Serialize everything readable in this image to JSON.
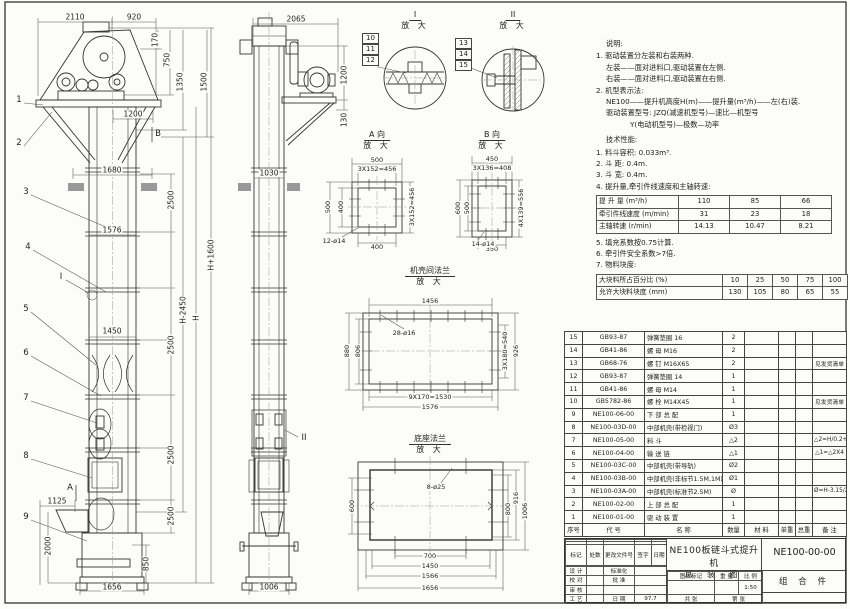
{
  "front": {
    "dims": {
      "d2110": "2110",
      "d920": "920",
      "d170": "170",
      "d750": "750",
      "d1350": "1350",
      "d1500": "1500",
      "d1200": "1200",
      "d1680": "1680",
      "d1576": "1576",
      "d1450": "1450",
      "d2500": "2500",
      "dHm2450": "H-2450",
      "dH": "H",
      "dHp1600": "H+1600",
      "d1125": "1125",
      "d2000": "2000",
      "d850": "850",
      "d1656": "1656"
    },
    "balloons": [
      "1",
      "2",
      "3",
      "4",
      "5",
      "6",
      "7",
      "8",
      "9"
    ],
    "markers": {
      "a": "A",
      "b": "B",
      "i": "I",
      "ii": "II"
    }
  },
  "side": {
    "dims": {
      "d2065": "2065",
      "d1200": "1200",
      "d130": "130",
      "d1030": "1030",
      "d1006": "1006"
    }
  },
  "details": {
    "enlarged": "放 大",
    "i": {
      "title": "I",
      "balloons": [
        "10",
        "11",
        "12"
      ]
    },
    "ii": {
      "title": "II",
      "balloons": [
        "13",
        "14",
        "15"
      ]
    },
    "a": {
      "title": "A 向",
      "top": "500",
      "top2": "3X152=456",
      "left": "500",
      "left2": "400",
      "bottom": "400",
      "right": "3X152=456",
      "holes": "12-ø14"
    },
    "b": {
      "title": "B 向",
      "top": "450",
      "top2": "3X136=408",
      "left": "600",
      "left2": "500",
      "bottom": "350",
      "right": "4X139=556",
      "holes": "14-ø14"
    },
    "flange": {
      "title": "机壳间法兰",
      "top": "1456",
      "holes": "28-ø16",
      "left": "880",
      "left2": "806",
      "right": "3X180=540",
      "right2": "926",
      "bottom": "9X170=1530",
      "bottom2": "1576"
    },
    "base": {
      "title": "底座法兰",
      "holes": "8-ø25",
      "left": "600",
      "right": "800",
      "right2": "916",
      "right3": "1006",
      "bottom": "700",
      "bottom2": "1450",
      "bottom3": "1566",
      "bottom4": "1656"
    }
  },
  "notes": {
    "title": "说明:",
    "lines": [
      "1. 驱动装置分左装和右装两种.",
      "左装——面对进料口,驱动装置在左侧.",
      "右装——面对进料口,驱动装置在右侧.",
      "2. 机型表示法:",
      "NE100——提升机高度H(m)——提升量(m³/h)——左(右)装.",
      "驱动装置型号: JZQ(减速机型号)—速比—机型号",
      "Y(电动机型号)—极数—功率"
    ]
  },
  "tech": {
    "title": "技术性能:",
    "items": [
      "1. 料斗容积: 0.033m³.",
      "2. 斗  距: 0.4m.",
      "3. 斗  宽: 0.4m.",
      "4. 提升量,牵引件线速度和主轴转速:"
    ],
    "speed_table": {
      "rows": [
        {
          "label": "提 升 量 (m³/h)",
          "values": [
            "110",
            "85",
            "66"
          ]
        },
        {
          "label": "牵引件线速度 (m/min)",
          "values": [
            "31",
            "23",
            "18"
          ]
        },
        {
          "label": "主轴转速 (r/min)",
          "values": [
            "14.13",
            "10.47",
            "8.21"
          ]
        }
      ]
    },
    "items2": [
      "5. 填充系数按0.75计算.",
      "6. 牵引件安全系数>7倍.",
      "7. 物料块度:"
    ],
    "block_table": {
      "rows": [
        {
          "label": "大块料所占百分比 (%)",
          "values": [
            "10",
            "25",
            "50",
            "75",
            "100"
          ]
        },
        {
          "label": "允许大块料块度 (mm)",
          "values": [
            "130",
            "105",
            "80",
            "65",
            "55"
          ]
        }
      ]
    }
  },
  "parts": {
    "headers": [
      "序号",
      "代  号",
      "名  称",
      "数量",
      "材  料",
      "单重",
      "总重",
      "备  注"
    ],
    "rows": [
      {
        "no": "15",
        "code": "GB93-87",
        "name": "弹簧垫圈 16",
        "qty": "2",
        "mat": "",
        "uw": "",
        "tw": "",
        "remark": ""
      },
      {
        "no": "14",
        "code": "GB41-86",
        "name": "螺 母 M16",
        "qty": "2",
        "mat": "",
        "uw": "",
        "tw": "",
        "remark": ""
      },
      {
        "no": "13",
        "code": "GB68-76",
        "name": "螺 钉 M16X65",
        "qty": "2",
        "mat": "",
        "uw": "",
        "tw": "",
        "remark": "见发货清单"
      },
      {
        "no": "12",
        "code": "GB93-87",
        "name": "弹簧垫圈 14",
        "qty": "1",
        "mat": "",
        "uw": "",
        "tw": "",
        "remark": ""
      },
      {
        "no": "11",
        "code": "GB41-86",
        "name": "螺 母 M14",
        "qty": "1",
        "mat": "",
        "uw": "",
        "tw": "",
        "remark": ""
      },
      {
        "no": "10",
        "code": "GB5782-86",
        "name": "螺 栓 M14X45",
        "qty": "1",
        "mat": "",
        "uw": "",
        "tw": "",
        "remark": "见发货清单"
      },
      {
        "no": "9",
        "code": "NE100-06-00",
        "name": "下 部 总 配",
        "qty": "1",
        "mat": "",
        "uw": "",
        "tw": "",
        "remark": ""
      },
      {
        "no": "8",
        "code": "NE100-03D-00",
        "name": "中部机壳(带检视门)",
        "qty": "Ø3",
        "mat": "",
        "uw": "",
        "tw": "",
        "remark": ""
      },
      {
        "no": "7",
        "code": "NE100-05-00",
        "name": "料  斗",
        "qty": "△2",
        "mat": "",
        "uw": "",
        "tw": "",
        "remark": "△2=H/0.2+5.75"
      },
      {
        "no": "6",
        "code": "NE100-04-00",
        "name": "输 送 链",
        "qty": "△1",
        "mat": "",
        "uw": "",
        "tw": "",
        "remark": "△1=△2X4"
      },
      {
        "no": "5",
        "code": "NE100-03C-00",
        "name": "中部机壳(带导轨)",
        "qty": "Ø2",
        "mat": "",
        "uw": "",
        "tw": "",
        "remark": ""
      },
      {
        "no": "4",
        "code": "NE100-03B-00",
        "name": "中部机壳(非标节1.5M,1M)",
        "qty": "Ø1",
        "mat": "",
        "uw": "",
        "tw": "",
        "remark": ""
      },
      {
        "no": "3",
        "code": "NE100-03A-00",
        "name": "中部机壳(标准节2.5M)",
        "qty": "Ø",
        "mat": "",
        "uw": "",
        "tw": "",
        "remark": "Ø=H-3.15/2.5"
      },
      {
        "no": "2",
        "code": "NE100-02-00",
        "name": "上 部 总 配",
        "qty": "1",
        "mat": "",
        "uw": "",
        "tw": "",
        "remark": ""
      },
      {
        "no": "1",
        "code": "NE100-01-00",
        "name": "驱 动 装 置",
        "qty": "1",
        "mat": "",
        "uw": "",
        "tw": "",
        "remark": ""
      }
    ]
  },
  "title_block": {
    "product": "NE100板链斗式提升机",
    "drawing_type": "总 装 图",
    "drawing_no": "NE100-00-00",
    "part_class": "组 合 件",
    "rev_headers": [
      "标记",
      "处数",
      "更改文件号",
      "签字",
      "日期"
    ],
    "sig_labels": [
      "设 计",
      "校 对",
      "审 核",
      "工 艺"
    ],
    "std": "标准化",
    "approve": "批 准",
    "date_label": "日 期",
    "date": "97.7",
    "stamp": "图样标记",
    "weight": "重 量",
    "scale_label": "比 例",
    "scale": "1:50",
    "sheets": "共  张",
    "sheet_no": "第  张"
  }
}
